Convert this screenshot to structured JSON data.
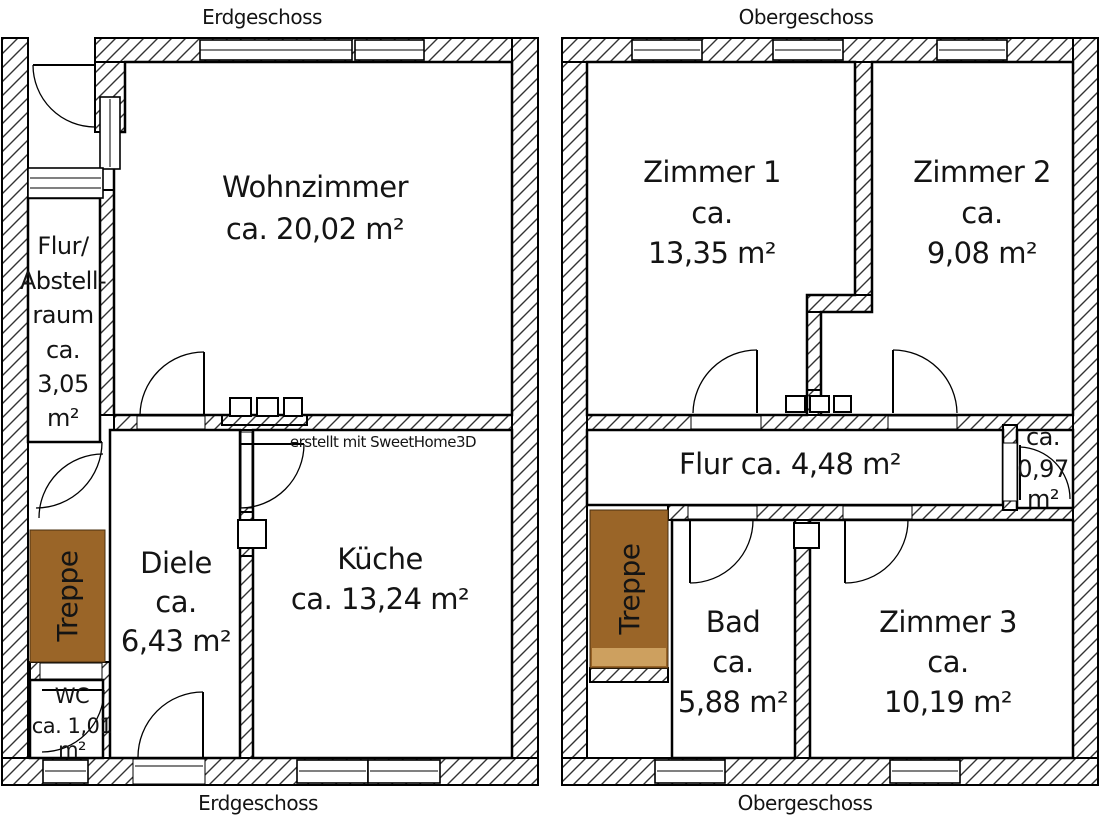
{
  "credit_text": "erstellt mit SweetHome3D",
  "colors": {
    "stairs_fill": "#9A6528",
    "stairs_step": "#CDA05F",
    "wall_line": "#000000"
  },
  "erdgeschoss": {
    "title": "Erdgeschoss",
    "rooms": {
      "wohnzimmer": {
        "name": "Wohnzimmer",
        "area": "ca. 20,02 m²"
      },
      "flur_abstellraum": {
        "line1": "Flur/",
        "line2": "Abstell-",
        "line3": "raum",
        "line4": "ca.",
        "line5": "3,05",
        "line6": "m²"
      },
      "diele": {
        "name": "Diele",
        "ca": "ca.",
        "area": "6,43 m²"
      },
      "kueche": {
        "name": "Küche",
        "area": "ca. 13,24 m²"
      },
      "wc": {
        "name": "WC",
        "line2": "ca. 1,01",
        "line3": "m²"
      },
      "treppe": {
        "name": "Treppe"
      }
    }
  },
  "obergeschoss": {
    "title": "Obergeschoss",
    "rooms": {
      "zimmer1": {
        "name": "Zimmer 1",
        "ca": "ca.",
        "area": "13,35 m²"
      },
      "zimmer2": {
        "name": "Zimmer 2",
        "ca": "ca.",
        "area": "9,08 m²"
      },
      "flur": {
        "label": "Flur ca. 4,48 m²"
      },
      "kammer": {
        "line1": "ca.",
        "line2": "0,97",
        "line3": "m²"
      },
      "bad": {
        "name": "Bad",
        "ca": "ca.",
        "area": "5,88 m²"
      },
      "zimmer3": {
        "name": "Zimmer 3",
        "ca": "ca.",
        "area": "10,19 m²"
      },
      "treppe": {
        "name": "Treppe"
      }
    }
  }
}
